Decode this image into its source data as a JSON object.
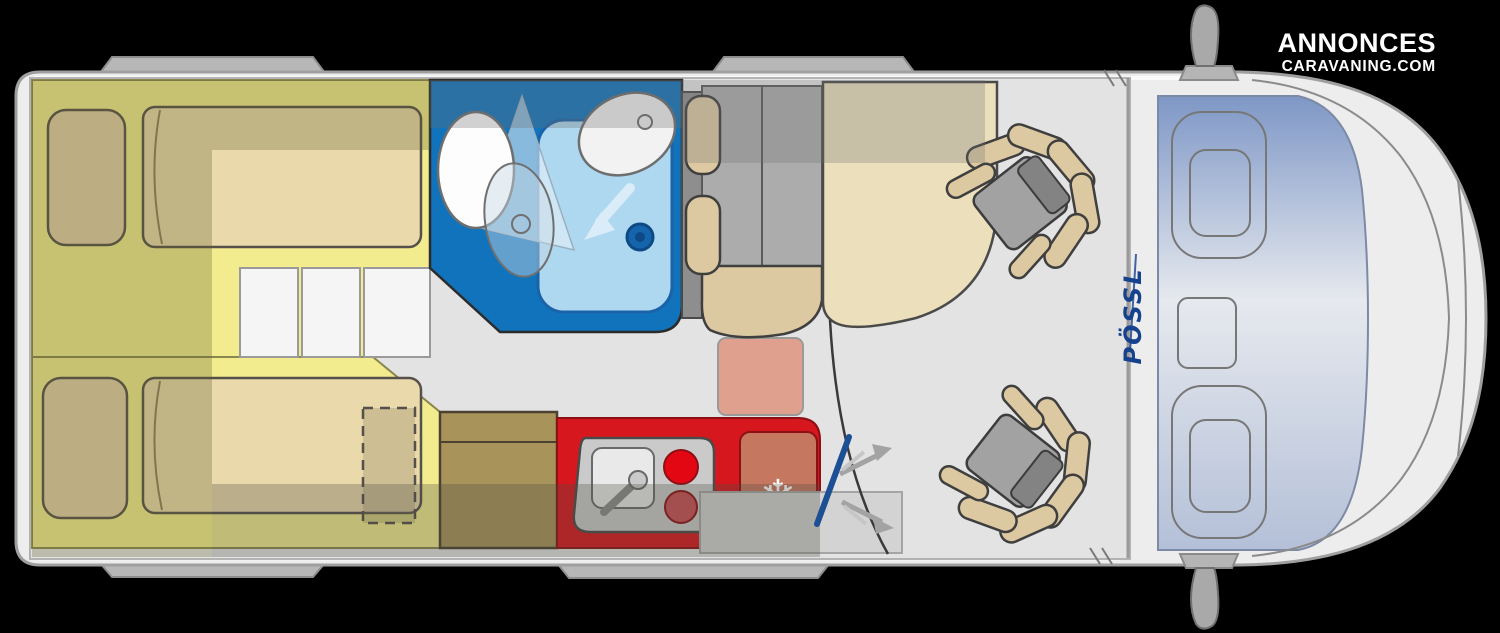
{
  "watermark": {
    "line1": "ANNONCES",
    "line2": "CARAVANING.COM"
  },
  "brand": {
    "name": "PÖSSL"
  },
  "icons": {
    "snowflake": "❄"
  },
  "colors": {
    "background": "#000000",
    "van_body": "#ededed",
    "van_outline": "#9f9f9f",
    "floor": "#e3e3e3",
    "bed_yellow": "#f3ec8e",
    "mattress_tan": "#ead9ab",
    "pillow_tan": "#e3d0a6",
    "drawer_white": "#f5f5f5",
    "bathroom_blue": "#1173bb",
    "shower_blue": "#aed7f0",
    "toilet_white": "#fdfdfd",
    "kitchen_red": "#d7171e",
    "fridge_salmon": "#c5785f",
    "burner_red": "#e30613",
    "burner_dim": "#c94f55",
    "wardrobe_khaki": "#a8945a",
    "heater_pink": "#dfa08d",
    "bench_gray": "#acacac",
    "seat_tan": "#dcc9a2",
    "seat_gray": "#a2a2a2",
    "table_cream": "#ebdfbc",
    "door_blue": "#1d4f94",
    "brand_blue": "#16418c",
    "snowflake_white": "#ffffff"
  }
}
